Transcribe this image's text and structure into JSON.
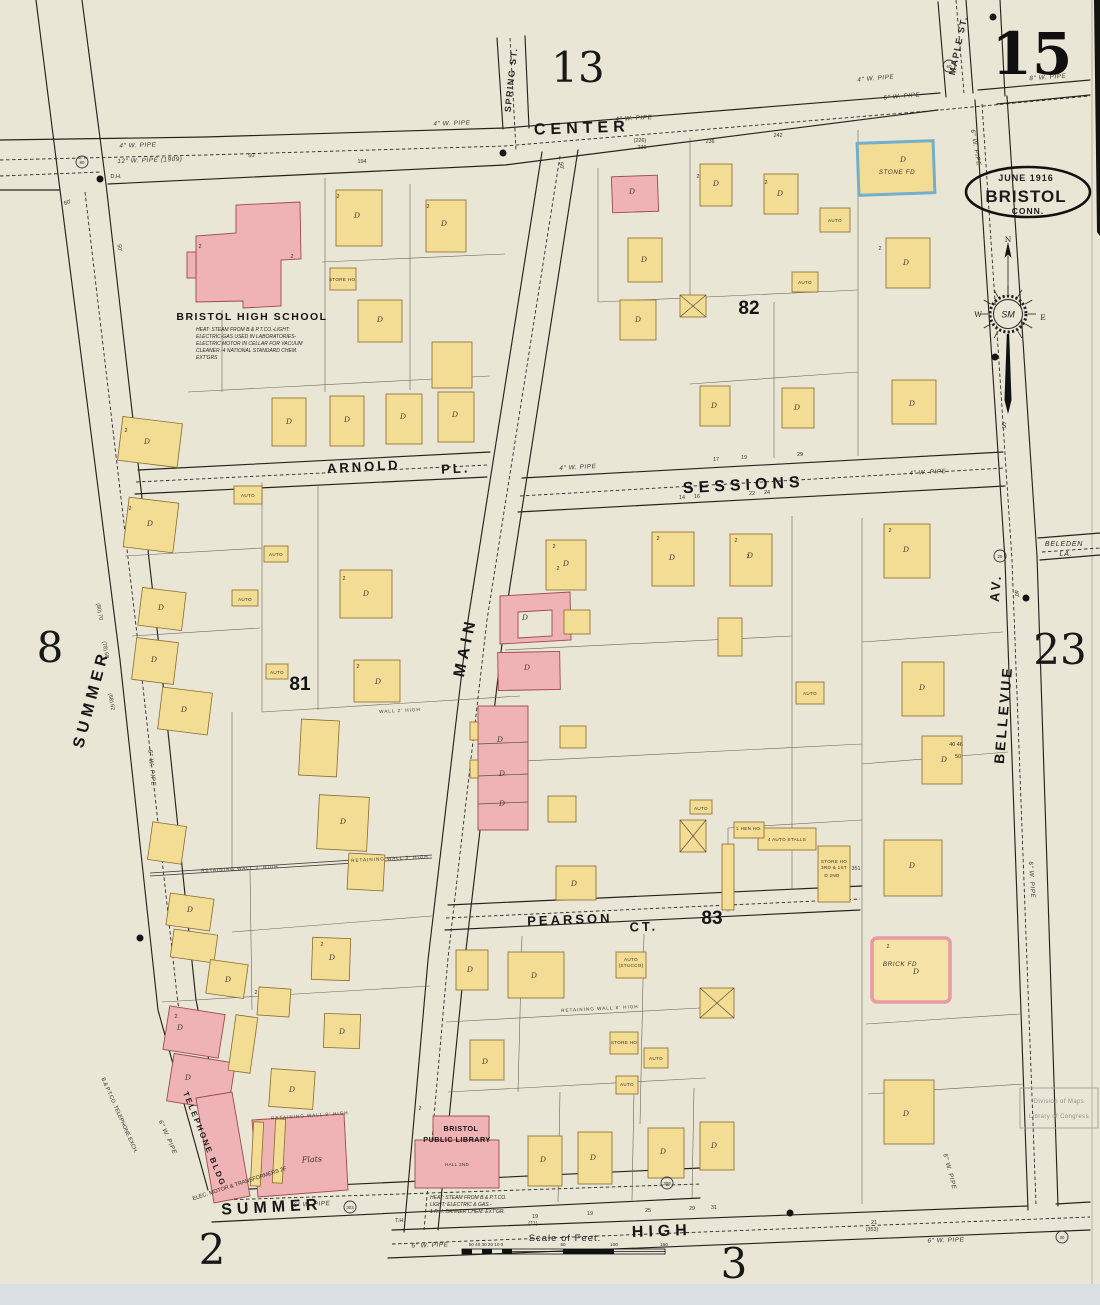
{
  "meta": {
    "sheet_number": "15"
  },
  "title_stamp": {
    "date": "June 1916",
    "city": "BRISTOL",
    "state": "CONN."
  },
  "adjacent_sheets": {
    "top": "13",
    "left": "8",
    "right": "23",
    "bottom_left": "2",
    "bottom": "3"
  },
  "blocks": {
    "b81": "81",
    "b82": "82",
    "b83": "83"
  },
  "streets": {
    "center": "CENTER",
    "summer_left": "SUMMER",
    "summer_bottom": "SUMMER",
    "main": "MAIN",
    "high": "HIGH",
    "sessions": "SESSIONS",
    "arnold": "ARNOLD",
    "arnold_pl": "PL.",
    "pearson": "PEARSON",
    "pearson_ct": "CT.",
    "bellevue": "BELLEVUE",
    "bellevue_av": "AV.",
    "maple": "MAPLE ST.",
    "spring": "SPRING ST.",
    "beleden1": "BELEDEN",
    "beleden2": "LA."
  },
  "buildings": {
    "high_school": {
      "name": "BRISTOL HIGH SCHOOL",
      "notes": [
        "HEAT: STEAM FROM B.& P.T.CO.-LIGHT:",
        "ELECTRIC-GAS USED IN LABORATORIES-",
        "ELECTRIC MOTOR IN CELLAR FOR VACUUM",
        "CLEANER.-4 NATIONAL STANDARD CHEM.",
        "EXT'GRS"
      ]
    },
    "library": {
      "name_line1": "BRISTOL",
      "name_line2": "PUBLIC LIBRARY",
      "notes": [
        "HEAT: STEAM FROM B.& P.T.CO.",
        "LIGHT: ELECTRIC & GAS.-",
        "1 R.H. BANNER CHEM. EXT'GR."
      ]
    },
    "telephone": "TELEPHONE BLDG",
    "flats": "Flats"
  },
  "compass": {
    "n": "N",
    "s": "S",
    "e": "E",
    "w": "W"
  },
  "scale": {
    "label": "Scale of Feet.",
    "ticks_left": "50 40 30 20 10  0",
    "t50": "50",
    "t100": "100",
    "t150": "150"
  },
  "stamp": {
    "line1": "Division of Maps",
    "line2": "Library of Congress"
  },
  "map_labels": [
    {
      "t": "4\" W. PIPE",
      "x": 138,
      "y": 147,
      "r": -2,
      "c": "pipe"
    },
    {
      "t": "12\" W. PIPE (1909)",
      "x": 150,
      "y": 162,
      "r": -2,
      "c": "pipe"
    },
    {
      "t": "4\" W. PIPE",
      "x": 452,
      "y": 125,
      "r": -2,
      "c": "pipe"
    },
    {
      "t": "4\" W. PIPE",
      "x": 634,
      "y": 120,
      "r": -3,
      "c": "pipe"
    },
    {
      "t": "4\" W. PIPE",
      "x": 876,
      "y": 80,
      "r": -5,
      "c": "pipe"
    },
    {
      "t": "6\" W. PIPE",
      "x": 902,
      "y": 98,
      "r": -5,
      "c": "pipe"
    },
    {
      "t": "8\" W. PIPE",
      "x": 1048,
      "y": 79,
      "r": -4,
      "c": "pipe"
    },
    {
      "t": "6\" W. PIPE",
      "x": 974,
      "y": 148,
      "r": 80,
      "c": "pipe"
    },
    {
      "t": "4\" W. PIPE",
      "x": 578,
      "y": 469,
      "r": -3,
      "c": "pipe"
    },
    {
      "t": "4\" W. PIPE",
      "x": 928,
      "y": 474,
      "r": -3,
      "c": "pipe"
    },
    {
      "t": "6\" W. PIPE",
      "x": 312,
      "y": 1206,
      "r": -3,
      "c": "pipe"
    },
    {
      "t": "6\" W. PIPE",
      "x": 430,
      "y": 1247,
      "r": -2,
      "c": "pipe"
    },
    {
      "t": "6\" W. PIPE",
      "x": 946,
      "y": 1242,
      "r": -2,
      "c": "pipe"
    },
    {
      "t": "6\" W. PIPE",
      "x": 948,
      "y": 1172,
      "r": 75,
      "c": "pipe"
    },
    {
      "t": "6\" W. PIPE",
      "x": 150,
      "y": 768,
      "r": 84,
      "c": "pipe",
      "s": 5.5
    },
    {
      "t": "6\" W. PIPE",
      "x": 1030,
      "y": 880,
      "r": 86,
      "c": "pipe",
      "s": 5.5
    },
    {
      "t": "6\" W. PIPE",
      "x": 166,
      "y": 1138,
      "r": 66,
      "c": "pipe",
      "s": 5
    },
    {
      "t": "D.H.",
      "x": 116,
      "y": 178,
      "s": 6
    },
    {
      "t": "T.H.",
      "x": 400,
      "y": 1222,
      "s": 5.5
    },
    {
      "t": "50'",
      "x": 252,
      "y": 157,
      "r": -4,
      "s": 6.5
    },
    {
      "t": "50'",
      "x": 560,
      "y": 166,
      "r": 80,
      "s": 6.5
    },
    {
      "t": "50'",
      "x": 68,
      "y": 204,
      "r": -20,
      "s": 6.5
    },
    {
      "t": "50'",
      "x": 118,
      "y": 248,
      "r": 82,
      "s": 6
    },
    {
      "t": "40'",
      "x": 1015,
      "y": 594,
      "r": 80,
      "s": 5.5
    },
    {
      "t": "194",
      "x": 362,
      "y": 163,
      "c": "num"
    },
    {
      "t": "(226)",
      "x": 640,
      "y": 142,
      "c": "num",
      "s": 5
    },
    {
      "t": "230",
      "x": 642,
      "y": 149,
      "c": "num",
      "s": 5
    },
    {
      "t": "236",
      "x": 710,
      "y": 143,
      "c": "num"
    },
    {
      "t": "242",
      "x": 778,
      "y": 137,
      "c": "num"
    },
    {
      "t": "17",
      "x": 716,
      "y": 461,
      "c": "num"
    },
    {
      "t": "19",
      "x": 744,
      "y": 459,
      "c": "num"
    },
    {
      "t": "29",
      "x": 800,
      "y": 456,
      "c": "num"
    },
    {
      "t": "14",
      "x": 682,
      "y": 499,
      "c": "num"
    },
    {
      "t": "16",
      "x": 697,
      "y": 498,
      "c": "num"
    },
    {
      "t": "22",
      "x": 752,
      "y": 495,
      "c": "num"
    },
    {
      "t": "24",
      "x": 767,
      "y": 494,
      "c": "num"
    },
    {
      "t": "19",
      "x": 535,
      "y": 1218,
      "c": "num"
    },
    {
      "t": "(11)",
      "x": 533,
      "y": 1225,
      "c": "num",
      "s": 5
    },
    {
      "t": "19",
      "x": 590,
      "y": 1215,
      "c": "num"
    },
    {
      "t": "25",
      "x": 648,
      "y": 1212,
      "c": "num"
    },
    {
      "t": "29",
      "x": 692,
      "y": 1210,
      "c": "num"
    },
    {
      "t": "31",
      "x": 714,
      "y": 1209,
      "c": "num"
    },
    {
      "t": "21",
      "x": 874,
      "y": 1224,
      "c": "num",
      "s": 5
    },
    {
      "t": "(353)",
      "x": 872,
      "y": 1231,
      "c": "num",
      "s": 5
    },
    {
      "t": "(80) 70",
      "x": 98,
      "y": 612,
      "r": 80,
      "c": "num",
      "s": 5
    },
    {
      "t": "(78) 68",
      "x": 104,
      "y": 650,
      "r": 80,
      "c": "num",
      "s": 5
    },
    {
      "t": "(68) 62",
      "x": 110,
      "y": 702,
      "r": 80,
      "c": "num",
      "s": 5
    },
    {
      "t": "40  46",
      "x": 956,
      "y": 746,
      "c": "num",
      "s": 5
    },
    {
      "t": "50",
      "x": 958,
      "y": 758,
      "c": "num",
      "s": 5
    },
    {
      "t": "STORE HO.",
      "x": 343,
      "y": 281,
      "c": "auto"
    },
    {
      "t": "STORE HO",
      "x": 624,
      "y": 1044,
      "c": "auto"
    },
    {
      "t": "STORE HO",
      "x": 834,
      "y": 863,
      "c": "auto"
    },
    {
      "t": "3RD & 1ST",
      "x": 834,
      "y": 869,
      "c": "auto"
    },
    {
      "t": "D 2ND",
      "x": 832,
      "y": 877,
      "c": "auto"
    },
    {
      "t": "351",
      "x": 856,
      "y": 870,
      "c": "num",
      "s": 5.5
    },
    {
      "t": "4 AUTO STALLS",
      "x": 787,
      "y": 841,
      "s": 5,
      "c": "auto"
    },
    {
      "t": "1 HEN HO.",
      "x": 749,
      "y": 830,
      "c": "auto",
      "s": 4.4
    },
    {
      "t": "BRICK FD",
      "x": 900,
      "y": 966,
      "c": "pipe",
      "s": 5.5
    },
    {
      "t": "STONE FD",
      "x": 897,
      "y": 174,
      "c": "pipe",
      "s": 5.5
    },
    {
      "t": "HALL 2ND",
      "x": 457,
      "y": 1166,
      "c": "auto",
      "s": 5
    },
    {
      "t": "AUTO",
      "x": 248,
      "y": 497,
      "c": "auto"
    },
    {
      "t": "AUTO",
      "x": 276,
      "y": 556,
      "c": "auto"
    },
    {
      "t": "AUTO",
      "x": 245,
      "y": 601,
      "c": "auto"
    },
    {
      "t": "AUTO",
      "x": 277,
      "y": 674,
      "c": "auto"
    },
    {
      "t": "AUTO",
      "x": 835,
      "y": 222,
      "c": "auto"
    },
    {
      "t": "AUTO",
      "x": 805,
      "y": 284,
      "c": "auto"
    },
    {
      "t": "AUTO",
      "x": 810,
      "y": 695,
      "c": "auto"
    },
    {
      "t": "AUTO",
      "x": 701,
      "y": 810,
      "c": "auto"
    },
    {
      "t": "AUTO",
      "x": 656,
      "y": 1060,
      "c": "auto"
    },
    {
      "t": "AUTO",
      "x": 627,
      "y": 1086,
      "c": "auto"
    },
    {
      "t": "AUTO",
      "x": 631,
      "y": 961,
      "c": "auto"
    },
    {
      "t": "(STUCCO)",
      "x": 631,
      "y": 967,
      "c": "auto",
      "s": 4
    },
    {
      "t": "RETAINING WALL 2' HIGH",
      "x": 240,
      "y": 870,
      "r": -3,
      "c": "wall"
    },
    {
      "t": "RETAINING WALL 3' HIGH",
      "x": 390,
      "y": 860,
      "r": -3,
      "c": "wall"
    },
    {
      "t": "WALL 2' HIGH",
      "x": 400,
      "y": 712,
      "r": -3,
      "c": "wall"
    },
    {
      "t": "RETAINING WALL 8' HIGH",
      "x": 310,
      "y": 1117,
      "r": -4,
      "c": "wall"
    },
    {
      "t": "RETAINING WALL 8' HIGH",
      "x": 600,
      "y": 1010,
      "r": -3,
      "c": "wall"
    },
    {
      "t": "ELEC. MOTOR & TRANSFORMERS 2F",
      "x": 240,
      "y": 1185,
      "r": -18,
      "s": 4.2
    },
    {
      "t": "B.& P.T.CO. TELEPHONE EXCH.",
      "x": 118,
      "y": 1116,
      "r": 66,
      "s": 4.2
    },
    {
      "t": "D",
      "x": 357,
      "y": 218,
      "c": "dmark"
    },
    {
      "t": "D",
      "x": 444,
      "y": 226,
      "c": "dmark"
    },
    {
      "t": "D",
      "x": 380,
      "y": 322,
      "c": "dmark"
    },
    {
      "t": "D",
      "x": 289,
      "y": 424,
      "c": "dmark"
    },
    {
      "t": "D",
      "x": 347,
      "y": 422,
      "c": "dmark"
    },
    {
      "t": "D",
      "x": 403,
      "y": 419,
      "c": "dmark"
    },
    {
      "t": "D",
      "x": 455,
      "y": 417,
      "c": "dmark"
    },
    {
      "t": "D",
      "x": 147,
      "y": 444,
      "c": "dmark"
    },
    {
      "t": "D",
      "x": 150,
      "y": 526,
      "c": "dmark"
    },
    {
      "t": "D",
      "x": 161,
      "y": 610,
      "c": "dmark"
    },
    {
      "t": "D",
      "x": 154,
      "y": 662,
      "c": "dmark"
    },
    {
      "t": "D",
      "x": 184,
      "y": 712,
      "c": "dmark"
    },
    {
      "t": "D",
      "x": 366,
      "y": 596,
      "c": "dmark"
    },
    {
      "t": "D",
      "x": 378,
      "y": 684,
      "c": "dmark"
    },
    {
      "t": "D",
      "x": 343,
      "y": 824,
      "c": "dmark"
    },
    {
      "t": "D",
      "x": 190,
      "y": 912,
      "c": "dmark"
    },
    {
      "t": "D",
      "x": 228,
      "y": 982,
      "c": "dmark"
    },
    {
      "t": "D",
      "x": 332,
      "y": 960,
      "c": "dmark"
    },
    {
      "t": "D",
      "x": 342,
      "y": 1034,
      "c": "dmark"
    },
    {
      "t": "D",
      "x": 292,
      "y": 1092,
      "c": "dmark"
    },
    {
      "t": "D",
      "x": 180,
      "y": 1030,
      "c": "dmark"
    },
    {
      "t": "D",
      "x": 188,
      "y": 1080,
      "c": "dmark"
    },
    {
      "t": "D",
      "x": 566,
      "y": 566,
      "c": "dmark"
    },
    {
      "t": "D",
      "x": 672,
      "y": 560,
      "c": "dmark"
    },
    {
      "t": "D",
      "x": 750,
      "y": 558,
      "c": "dmark"
    },
    {
      "t": "D",
      "x": 906,
      "y": 552,
      "c": "dmark"
    },
    {
      "t": "D",
      "x": 922,
      "y": 690,
      "c": "dmark"
    },
    {
      "t": "D",
      "x": 944,
      "y": 762,
      "c": "dmark"
    },
    {
      "t": "D",
      "x": 912,
      "y": 868,
      "c": "dmark"
    },
    {
      "t": "D",
      "x": 916,
      "y": 974,
      "c": "dmark"
    },
    {
      "t": "D",
      "x": 716,
      "y": 186,
      "c": "dmark"
    },
    {
      "t": "D",
      "x": 780,
      "y": 196,
      "c": "dmark"
    },
    {
      "t": "D",
      "x": 644,
      "y": 262,
      "c": "dmark"
    },
    {
      "t": "D",
      "x": 638,
      "y": 322,
      "c": "dmark"
    },
    {
      "t": "D",
      "x": 714,
      "y": 408,
      "c": "dmark"
    },
    {
      "t": "D",
      "x": 797,
      "y": 410,
      "c": "dmark"
    },
    {
      "t": "D",
      "x": 912,
      "y": 406,
      "c": "dmark"
    },
    {
      "t": "D",
      "x": 906,
      "y": 265,
      "c": "dmark"
    },
    {
      "t": "D",
      "x": 903,
      "y": 162,
      "c": "dmark"
    },
    {
      "t": "D",
      "x": 632,
      "y": 194,
      "c": "dmark"
    },
    {
      "t": "D",
      "x": 525,
      "y": 620,
      "c": "dmark"
    },
    {
      "t": "D",
      "x": 527,
      "y": 670,
      "c": "dmark"
    },
    {
      "t": "D",
      "x": 500,
      "y": 742,
      "c": "dmark"
    },
    {
      "t": "D",
      "x": 502,
      "y": 776,
      "c": "dmark"
    },
    {
      "t": "D",
      "x": 502,
      "y": 806,
      "c": "dmark"
    },
    {
      "t": "D",
      "x": 543,
      "y": 1162,
      "c": "dmark"
    },
    {
      "t": "D",
      "x": 593,
      "y": 1160,
      "c": "dmark"
    },
    {
      "t": "D",
      "x": 663,
      "y": 1154,
      "c": "dmark"
    },
    {
      "t": "D",
      "x": 714,
      "y": 1148,
      "c": "dmark"
    },
    {
      "t": "D",
      "x": 470,
      "y": 972,
      "c": "dmark"
    },
    {
      "t": "D",
      "x": 534,
      "y": 978,
      "c": "dmark"
    },
    {
      "t": "D",
      "x": 574,
      "y": 886,
      "c": "dmark"
    },
    {
      "t": "D",
      "x": 906,
      "y": 1116,
      "c": "dmark"
    },
    {
      "t": "D",
      "x": 485,
      "y": 1064,
      "c": "dmark"
    },
    {
      "t": "2",
      "x": 338,
      "y": 198,
      "c": "num",
      "s": 5
    },
    {
      "t": "2",
      "x": 428,
      "y": 208,
      "c": "num",
      "s": 5
    },
    {
      "t": "2",
      "x": 200,
      "y": 248,
      "c": "num",
      "s": 5
    },
    {
      "t": "2",
      "x": 292,
      "y": 258,
      "c": "num",
      "s": 5
    },
    {
      "t": "2",
      "x": 126,
      "y": 432,
      "c": "num",
      "s": 5
    },
    {
      "t": "2",
      "x": 130,
      "y": 510,
      "c": "num",
      "s": 5
    },
    {
      "t": "2",
      "x": 344,
      "y": 580,
      "c": "num",
      "s": 5
    },
    {
      "t": "2",
      "x": 358,
      "y": 668,
      "c": "num",
      "s": 5
    },
    {
      "t": "2",
      "x": 698,
      "y": 178,
      "c": "num",
      "s": 5
    },
    {
      "t": "2",
      "x": 766,
      "y": 184,
      "c": "num",
      "s": 5
    },
    {
      "t": "2",
      "x": 880,
      "y": 250,
      "c": "num",
      "s": 5
    },
    {
      "t": "2",
      "x": 748,
      "y": 558,
      "c": "num",
      "s": 5
    },
    {
      "t": "2",
      "x": 558,
      "y": 570,
      "c": "num",
      "s": 5
    },
    {
      "t": "2",
      "x": 888,
      "y": 948,
      "c": "num",
      "s": 5
    },
    {
      "t": "2",
      "x": 420,
      "y": 1110,
      "c": "num",
      "s": 5
    },
    {
      "t": "2",
      "x": 176,
      "y": 1018,
      "c": "num",
      "s": 5
    },
    {
      "t": "2",
      "x": 256,
      "y": 994,
      "c": "num",
      "s": 5
    },
    {
      "t": "2",
      "x": 322,
      "y": 946,
      "c": "num",
      "s": 5
    },
    {
      "t": "2",
      "x": 554,
      "y": 548,
      "c": "num",
      "s": 5
    },
    {
      "t": "2",
      "x": 658,
      "y": 540,
      "c": "num",
      "s": 5
    },
    {
      "t": "2",
      "x": 736,
      "y": 542,
      "c": "num",
      "s": 5
    },
    {
      "t": "2",
      "x": 890,
      "y": 532,
      "c": "num",
      "s": 5
    },
    {
      "t": "80",
      "x": 82,
      "y": 162,
      "c": "circled"
    },
    {
      "t": "60",
      "x": 949,
      "y": 66,
      "c": "circled"
    },
    {
      "t": "309",
      "x": 667,
      "y": 1183,
      "c": "circled"
    },
    {
      "t": "303",
      "x": 350,
      "y": 1207,
      "c": "circled"
    },
    {
      "t": "29",
      "x": 1000,
      "y": 556,
      "c": "circled"
    },
    {
      "t": "30",
      "x": 1062,
      "y": 1237,
      "c": "circled"
    }
  ]
}
